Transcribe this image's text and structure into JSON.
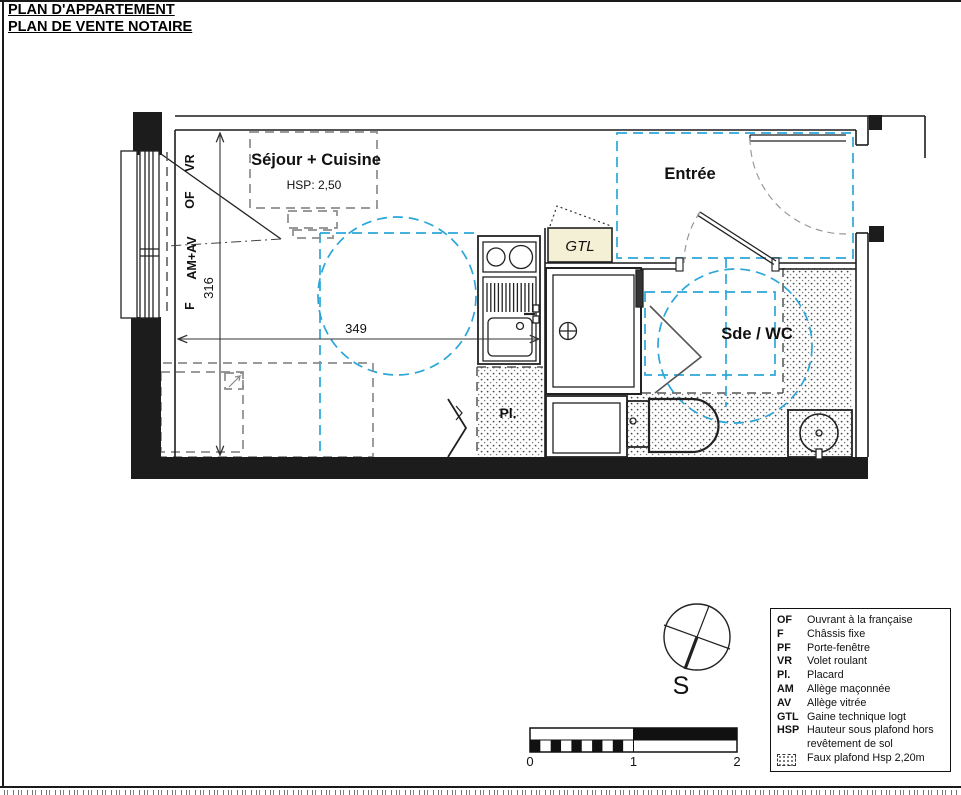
{
  "title": {
    "line1": "PLAN D'APPARTEMENT",
    "line2": "PLAN DE VENTE NOTAIRE"
  },
  "rooms": {
    "sejour": {
      "name": "Séjour + Cuisine",
      "hsp": "HSP: 2,50"
    },
    "entree": {
      "name": "Entrée"
    },
    "sde_wc": {
      "name": "Sde / WC"
    },
    "placard": {
      "name": "Pl."
    },
    "gtl": {
      "name": "GTL"
    }
  },
  "dimensions": {
    "width": "349",
    "height": "316"
  },
  "window_labels": {
    "vr": "VR",
    "of": "OF",
    "am_av": "AM+AV",
    "f": "F"
  },
  "compass": {
    "south": "S"
  },
  "scale_bar": {
    "ticks": [
      "0",
      "1",
      "2"
    ]
  },
  "legend": {
    "items": [
      {
        "key": "OF",
        "label": "Ouvrant à la française"
      },
      {
        "key": "F",
        "label": "Châssis fixe"
      },
      {
        "key": "PF",
        "label": "Porte-fenêtre"
      },
      {
        "key": "VR",
        "label": "Volet roulant"
      },
      {
        "key": "Pl.",
        "label": "Placard"
      },
      {
        "key": "AM",
        "label": "Allège maçonnée"
      },
      {
        "key": "AV",
        "label": "Allège vitrée"
      },
      {
        "key": "GTL",
        "label": "Gaine technique logt"
      },
      {
        "key": "HSP",
        "label": "Hauteur sous plafond hors revêtement de sol"
      },
      {
        "key": "",
        "label": "Faux plafond Hsp 2,20m",
        "icon": "faux-plafond-swatch"
      }
    ]
  },
  "colors": {
    "wall": "#1c1c1c",
    "faux_plafond_dashed": "#2ba6d9",
    "gtl_fill": "#f4f0d6",
    "furniture_dashed": "#8c8c8c",
    "hatch_dot": "#4a4a4a"
  }
}
